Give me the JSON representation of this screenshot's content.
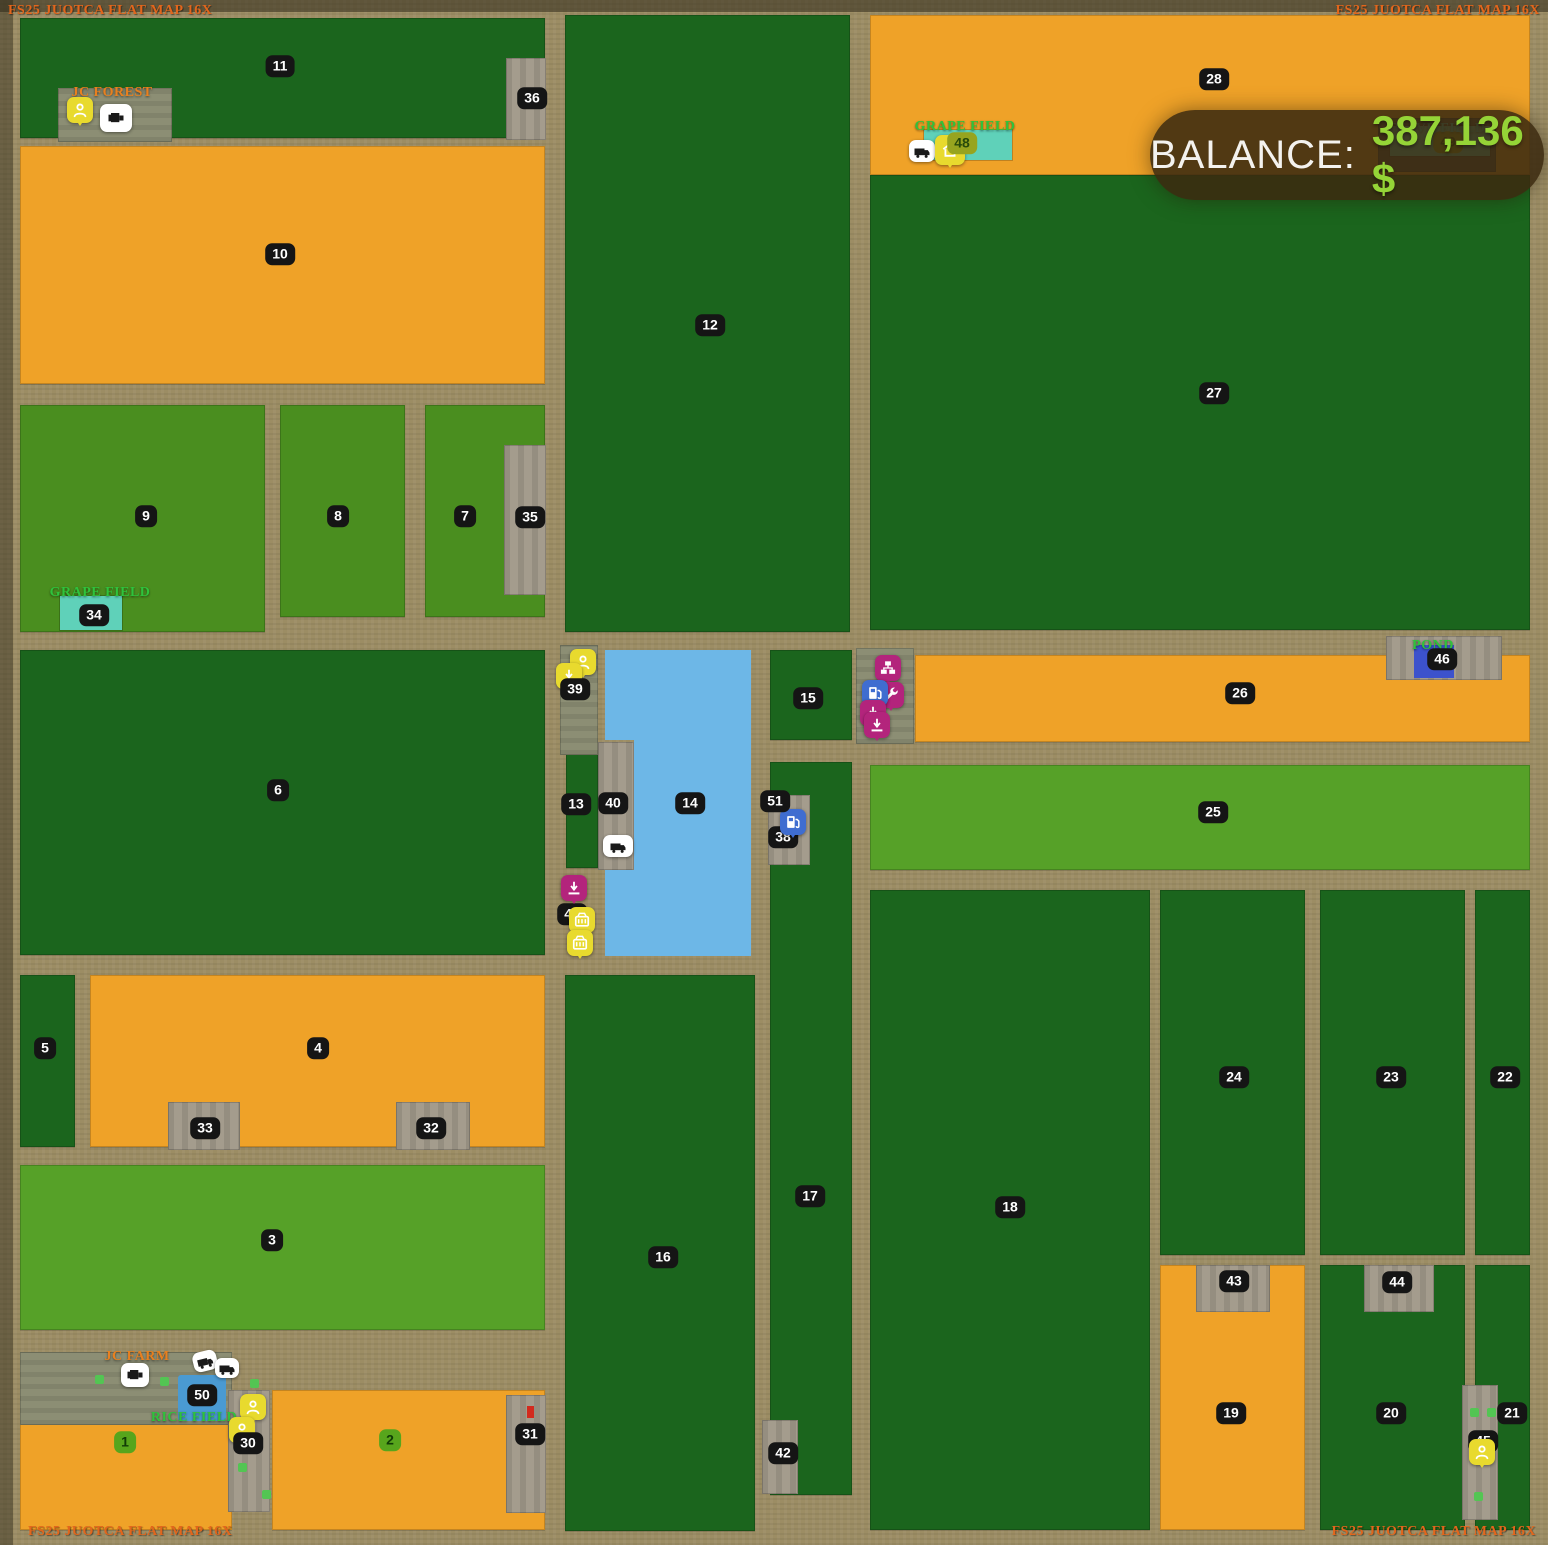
{
  "watermark": "FS25 JUOTCA FLAT MAP 16X",
  "balance": {
    "label": "BALANCE:",
    "amount": "387,136 $"
  },
  "map_labels": {
    "jc_forest": "JC FOREST",
    "grape_field_top": "GRAPE FIELD",
    "olive_field": "OLIVE FIELD",
    "grape_field_left": "GRAPE FIELD",
    "pond": "POND",
    "jc_farm": "JC FARM",
    "rice_field": "RICE FIELD"
  },
  "field_numbers": {
    "f1": "1",
    "f2": "2",
    "f3": "3",
    "f4": "4",
    "f5": "5",
    "f6": "6",
    "f7": "7",
    "f8": "8",
    "f9": "9",
    "f10": "10",
    "f11": "11",
    "f12": "12",
    "f13": "13",
    "f14": "14",
    "f15": "15",
    "f16": "16",
    "f17": "17",
    "f18": "18",
    "f19": "19",
    "f20": "20",
    "f21": "21",
    "f22": "22",
    "f23": "23",
    "f24": "24",
    "f25": "25",
    "f26": "26",
    "f27": "27",
    "f28": "28",
    "f30": "30",
    "f31": "31",
    "f32": "32",
    "f33": "33",
    "f34": "34",
    "f35": "35",
    "f36": "36",
    "f38": "38",
    "f39": "39",
    "f40": "40",
    "f41": "41",
    "f42": "42",
    "f43": "43",
    "f44": "44",
    "f45": "45",
    "f46": "46",
    "f48": "48",
    "f49": "49",
    "f50": "50",
    "f51": "51"
  },
  "icons": {
    "player": "person silhouette (yellow marker)",
    "unload_point": "down arrow onto line (magenta marker)",
    "production_point": "org-chart boxes (magenta marker)",
    "workshop": "wrench (magenta marker)",
    "fuel_station": "fuel pump (blue marker)",
    "basket": "crate/basket (yellow marker)",
    "shop": "house (yellow marker)",
    "vehicle": "truck/harvester (white marker)"
  },
  "colors": {
    "field_dark_green": "#1b651d",
    "field_orange": "#efa228",
    "field_mid_green": "#4a8e1f",
    "field_light_green": "#56a128",
    "water": "#6db7e7",
    "pond_blue": "#3c52cc",
    "teal_area": "#5fd1b9",
    "road": "#9c8d64",
    "badge_black": "#151515",
    "badge_green": "#57a51c",
    "icon_yellow": "#e8da2e",
    "icon_magenta": "#b3247c",
    "icon_blue": "#3f6dd0",
    "balance_amount_green": "#95d437",
    "watermark_orange": "#e2661c"
  }
}
